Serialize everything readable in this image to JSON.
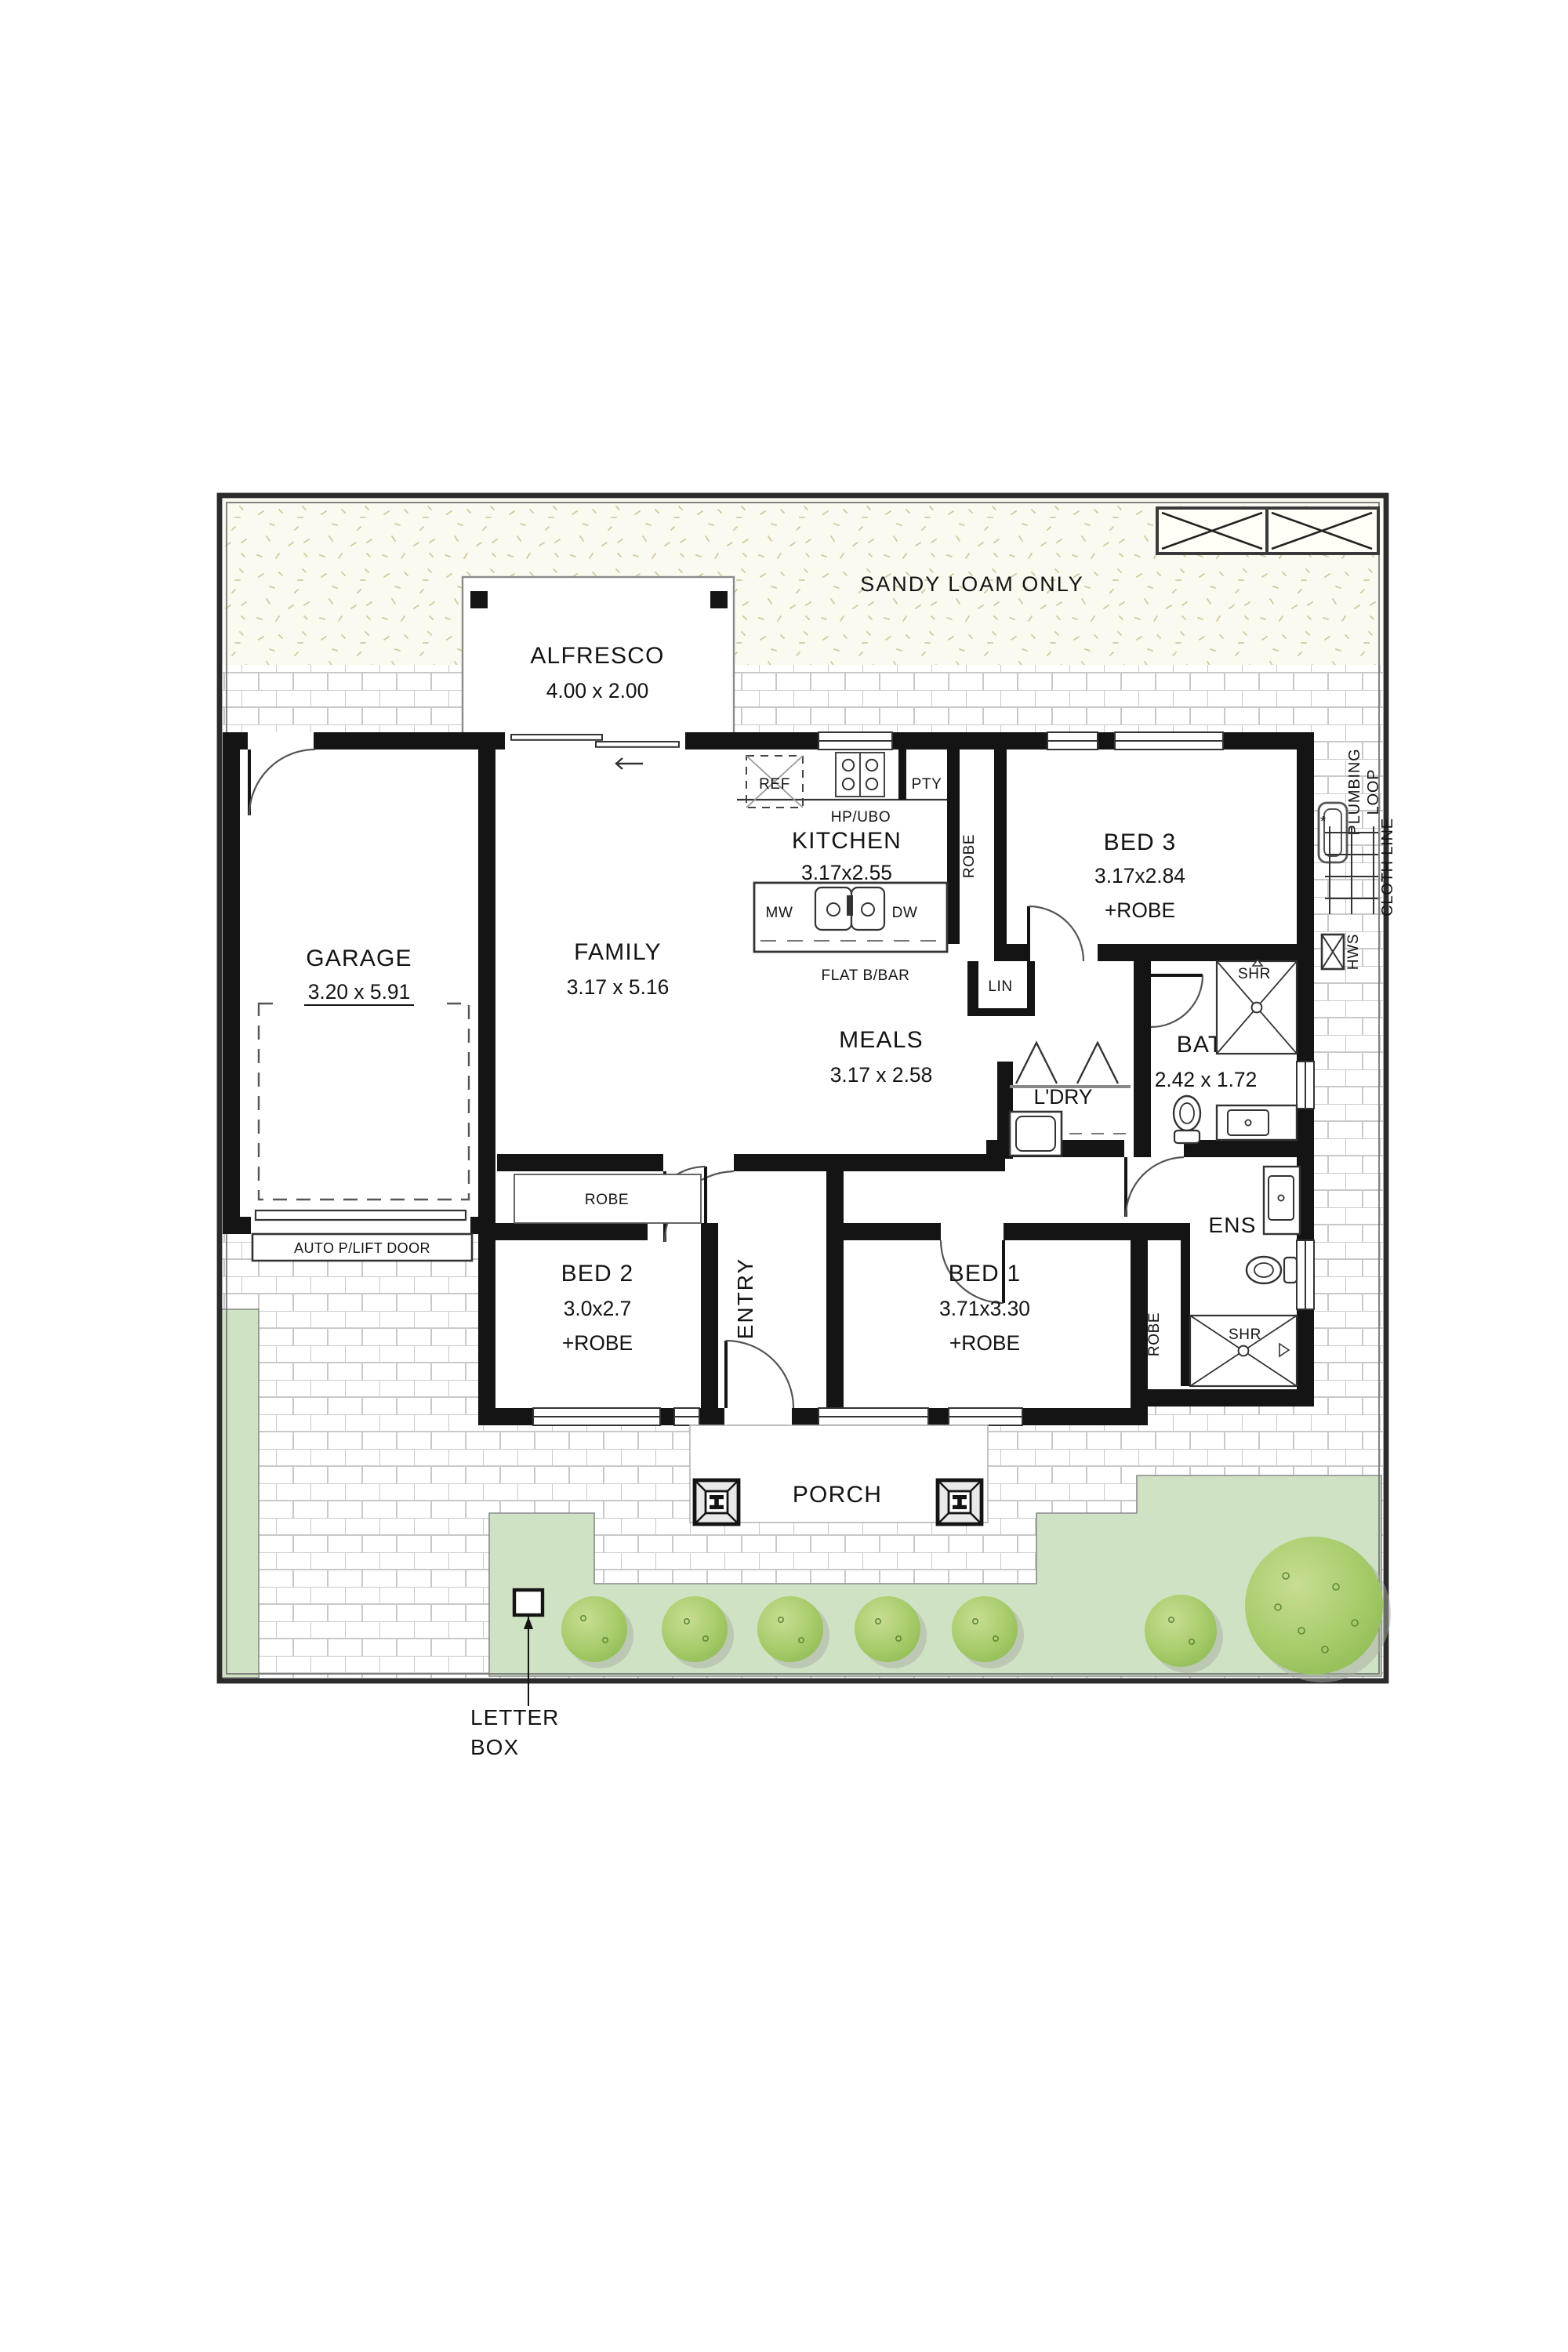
{
  "site": {
    "sandy_note": "SANDY LOAM ONLY",
    "letterbox": {
      "line1": "LETTER",
      "line2": "BOX"
    },
    "plumbing_loop": {
      "line1": "PLUMBING",
      "line2": "LOOP"
    },
    "cloth_line": "CLOTH LINE",
    "hws": "HWS"
  },
  "house": {
    "rooms": {
      "garage": {
        "name": "GARAGE",
        "dims": "3.20 x 5.91"
      },
      "alfresco": {
        "name": "ALFRESCO",
        "dims": "4.00 x 2.00"
      },
      "family": {
        "name": "FAMILY",
        "dims": "3.17 x 5.16"
      },
      "kitchen": {
        "name": "KITCHEN",
        "dims": "3.17x2.55"
      },
      "meals": {
        "name": "MEALS",
        "dims": "3.17 x 2.58"
      },
      "bed1": {
        "name": "BED 1",
        "dims": "3.71x3.30",
        "extra": "+ROBE"
      },
      "bed2": {
        "name": "BED 2",
        "dims": "3.0x2.7",
        "extra": "+ROBE"
      },
      "bed3": {
        "name": "BED 3",
        "dims": "3.17x2.84",
        "extra": "+ROBE"
      },
      "bath": {
        "name": "BATH",
        "dims": "2.42 x 1.72"
      },
      "ens": {
        "name": "ENS"
      },
      "ldry": {
        "name": "L'DRY"
      },
      "porch": {
        "name": "PORCH"
      },
      "entry": {
        "name": "ENTRY"
      }
    },
    "features": {
      "auto_door": "AUTO P/LIFT DOOR",
      "ref": "REF",
      "pty": "PTY",
      "hp_ubo": "HP/UBO",
      "mw": "MW",
      "dw": "DW",
      "flat_bbar": "FLAT B/BAR",
      "lin": "LIN",
      "shr_bath": "SHR",
      "shr_ens": "SHR",
      "robe_bed1": "ROBE",
      "robe_bed2": "ROBE",
      "robe_bed3": "ROBE"
    }
  },
  "colors": {
    "wall": "#141414",
    "lawn": "#cfe2c3",
    "bush_light": "#bed687",
    "bush_dark": "#93bf58",
    "sand_speckle": "#cfcaa0",
    "brick_joint": "#c9c9c9"
  }
}
